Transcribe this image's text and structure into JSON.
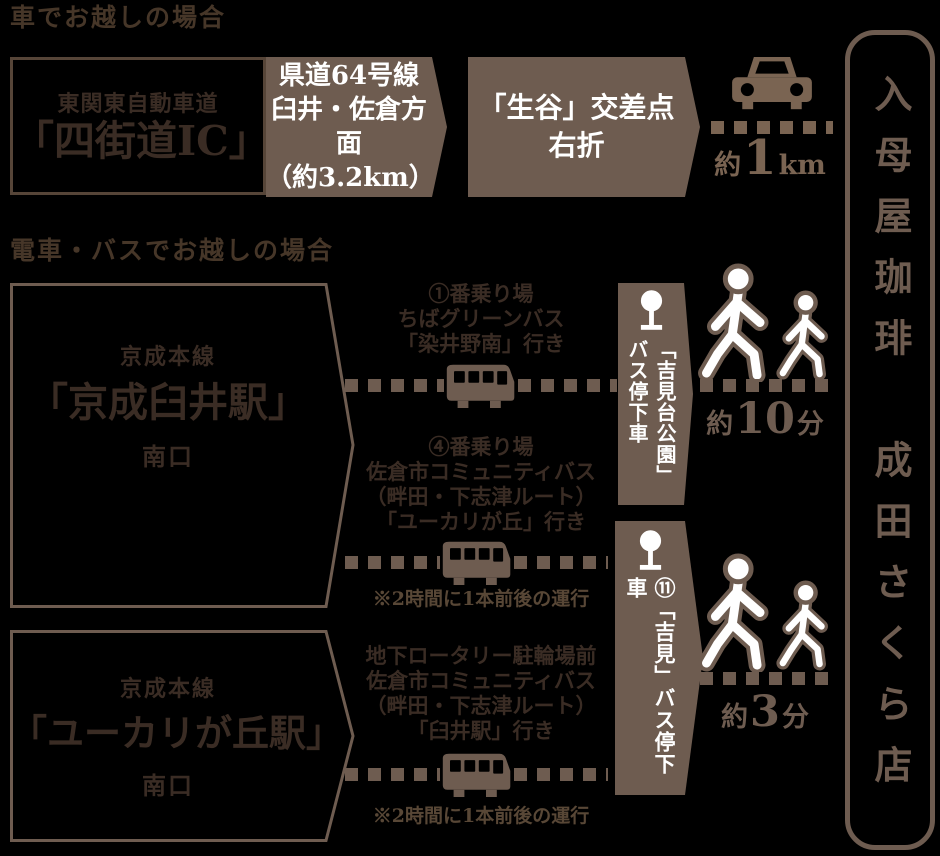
{
  "colors": {
    "background": "#000000",
    "brown_fill": "#6E5C50",
    "brown_icon": "#7A6452",
    "dark_text": "#3A2C24",
    "white_text": "#FFFFFF"
  },
  "shop": {
    "name": "入母屋珈琲　成田さくら店"
  },
  "car_access": {
    "heading": "車でお越しの場合",
    "origin": {
      "road": "東関東自動車道",
      "ic": "「四街道IC」"
    },
    "step1": [
      "県道64号線",
      "臼井・佐倉方面",
      "（約3.2km）"
    ],
    "step2": [
      "「生谷」交差点",
      "右折"
    ],
    "distance": {
      "prefix": "約",
      "value": "1",
      "unit": "km"
    }
  },
  "transit_access": {
    "heading": "電車・バスでお越しの場合",
    "usui": {
      "line": "京成本線",
      "station": "「京成臼井駅」",
      "exit": "南口",
      "bus_a": [
        "①番乗り場",
        "ちばグリーンバス",
        "「染井野南」行き"
      ],
      "bus_b": [
        "④番乗り場",
        "佐倉市コミュニティバス",
        "（畔田・下志津ルート）",
        "「ユーカリが丘」行き"
      ],
      "bus_b_note": "※2時間に1本前後の運行",
      "stop": "「吉見台公園」\nバス停下車",
      "walk": {
        "prefix": "約",
        "value": "10",
        "unit": "分"
      }
    },
    "yukarigaoka": {
      "line": "京成本線",
      "station": "「ユーカリが丘駅」",
      "exit": "南口",
      "bus": [
        "地下ロータリー駐輪場前",
        "佐倉市コミュニティバス",
        "（畔田・下志津ルート）",
        "「臼井駅」行き"
      ],
      "bus_note": "※2時間に1本前後の運行",
      "stop": "⑪「吉見」バス停下車",
      "walk": {
        "prefix": "約",
        "value": "3",
        "unit": "分"
      }
    }
  }
}
